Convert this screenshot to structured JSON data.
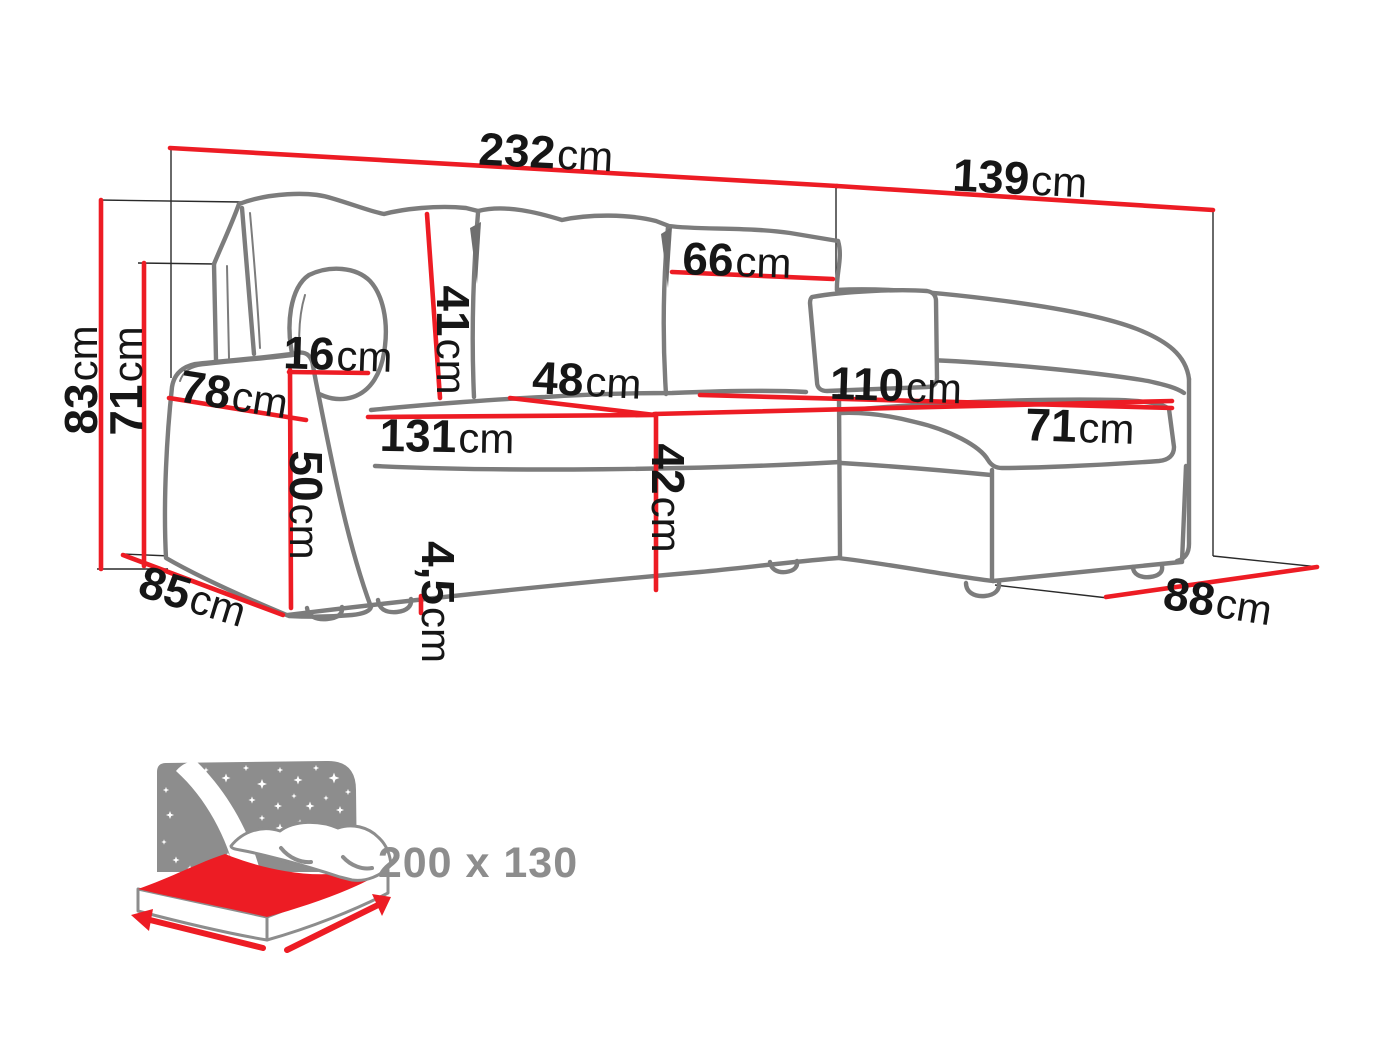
{
  "figure": "corner-sofa-dimension-diagram",
  "colors": {
    "dimension_red": "#ed1c24",
    "sofa_outline_gray": "#7c7c7c",
    "icon_gray": "#8d8d8d",
    "label_black": "#161616"
  },
  "dimensions": [
    {
      "id": "overall-width",
      "value": "232",
      "unit": "cm"
    },
    {
      "id": "overall-depth",
      "value": "139",
      "unit": "cm"
    },
    {
      "id": "overall-height",
      "value": "83",
      "unit": "cm"
    },
    {
      "id": "backrest-height",
      "value": "71",
      "unit": "cm"
    },
    {
      "id": "back-cushion-height",
      "value": "41",
      "unit": "cm"
    },
    {
      "id": "back-cushion-width",
      "value": "66",
      "unit": "cm"
    },
    {
      "id": "armrest-width",
      "value": "16",
      "unit": "cm"
    },
    {
      "id": "armrest-depth",
      "value": "78",
      "unit": "cm"
    },
    {
      "id": "armrest-height",
      "value": "50",
      "unit": "cm"
    },
    {
      "id": "seat-width",
      "value": "131",
      "unit": "cm"
    },
    {
      "id": "seat-depth",
      "value": "48",
      "unit": "cm"
    },
    {
      "id": "seat-height",
      "value": "42",
      "unit": "cm"
    },
    {
      "id": "chaise-length",
      "value": "110",
      "unit": "cm"
    },
    {
      "id": "chaise-seat-width",
      "value": "71",
      "unit": "cm"
    },
    {
      "id": "leg-height",
      "value": "4,5",
      "unit": "cm"
    },
    {
      "id": "side-depth-left",
      "value": "85",
      "unit": "cm"
    },
    {
      "id": "side-depth-right",
      "value": "88",
      "unit": "cm"
    }
  ],
  "sleeping_area": {
    "label": "200 x 130"
  }
}
